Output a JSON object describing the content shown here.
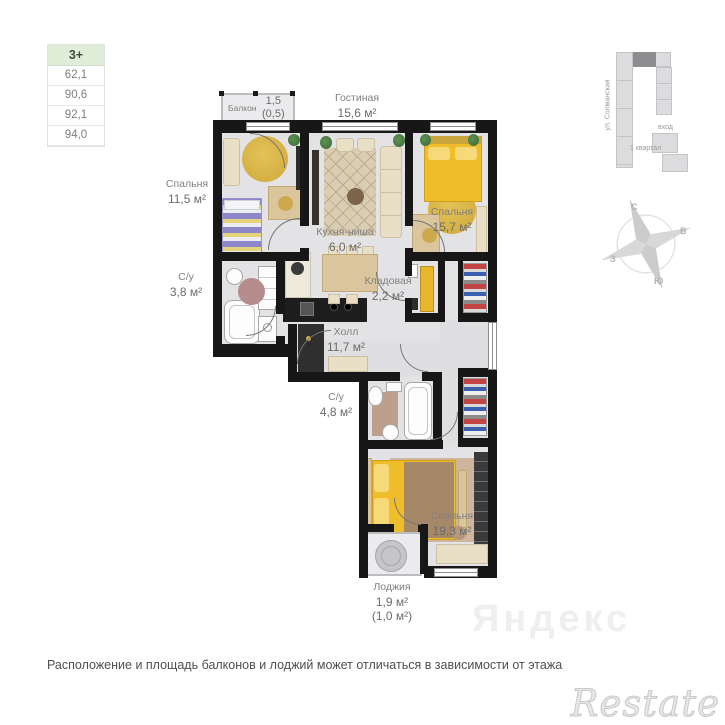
{
  "legend": {
    "plan_type": "3+",
    "areas": [
      "62,1",
      "90,6",
      "92,1",
      "94,0"
    ]
  },
  "rooms": {
    "balcony": {
      "name": "Балкон",
      "area": "1,5",
      "area_note": "(0,5)"
    },
    "living": {
      "name": "Гостиная",
      "area": "15,6 м²"
    },
    "bedroom1": {
      "name": "Спальня",
      "area": "11,5 м²"
    },
    "bath1": {
      "name": "С/у",
      "area": "3,8 м²"
    },
    "kitchen": {
      "name": "Кухня-ниша",
      "area": "6,0 м²"
    },
    "bedroom2": {
      "name": "Спальня",
      "area": "15,7 м²"
    },
    "storage": {
      "name": "Кладовая",
      "area": "2,2 м²"
    },
    "hall": {
      "name": "Холл",
      "area": "11,7 м²"
    },
    "bath2": {
      "name": "С/у",
      "area": "4,8 м²"
    },
    "bedroom3": {
      "name": "Спальня",
      "area": "19,3 м²"
    },
    "loggia": {
      "name": "Лоджия",
      "area": "1,9 м²",
      "area_note": "(1,0 м²)"
    }
  },
  "minimap": {
    "street": "ул. Солманская",
    "entrance_label": "вход",
    "district_label": "1 квартал"
  },
  "compass": {
    "north": "С",
    "east": "В",
    "south": "Ю",
    "west": "З"
  },
  "footer_note": "Расположение и площадь балконов и лоджий может отличаться в зависимости от этажа",
  "watermarks": {
    "brand": "Restate",
    "ghost": "Яндекс"
  }
}
